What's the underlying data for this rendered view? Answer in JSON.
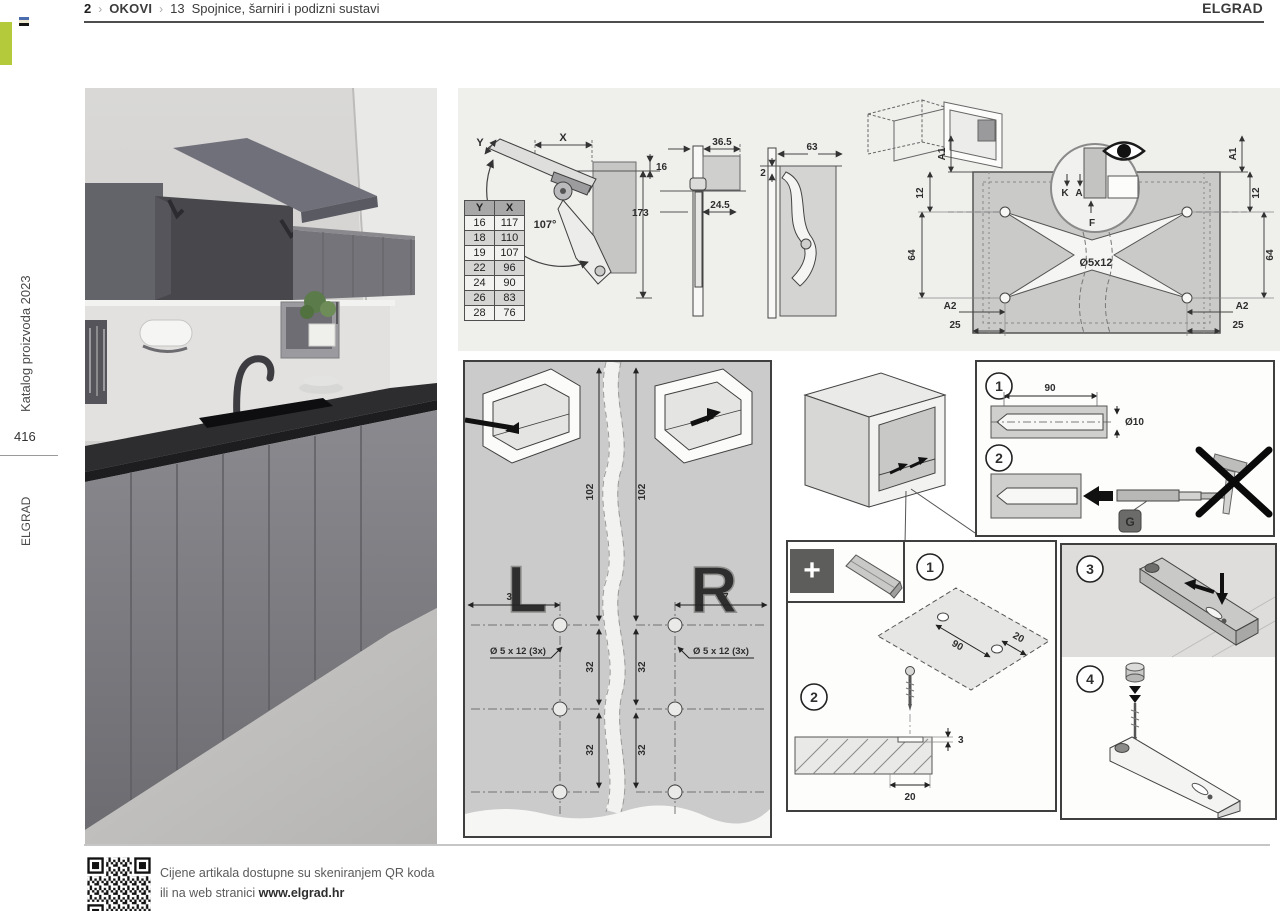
{
  "header": {
    "page_num": "2",
    "separator": "›",
    "section": "OKOVI",
    "chapter_num": "13",
    "chapter_title": "Spojnice, šarniri i podizni sustavi",
    "brand": "ELGRAD"
  },
  "sidebar": {
    "catalog": "Katalog proizvoda 2023",
    "page_number": "416",
    "brand": "ELGRAD"
  },
  "colors": {
    "accent_green": "#b5ca3b"
  },
  "hinge_diagram": {
    "table": {
      "headers": [
        "Y",
        "X"
      ],
      "rows": [
        [
          "16",
          "117"
        ],
        [
          "18",
          "110"
        ],
        [
          "19",
          "107"
        ],
        [
          "22",
          "96"
        ],
        [
          "24",
          "90"
        ],
        [
          "26",
          "83"
        ],
        [
          "28",
          "76"
        ]
      ]
    },
    "angle": "107°",
    "dim_x": "X",
    "dim_y": "Y",
    "dim_16": "16",
    "dim_173": "173"
  },
  "profile_diagram": {
    "dim_36_5": "36.5",
    "dim_24_5": "24.5",
    "dim_63": "63",
    "dim_2": "2"
  },
  "drilling_diagram": {
    "a1": "A1",
    "a2": "A2",
    "d12": "12",
    "d64": "64",
    "d25": "25",
    "hole_spec": "Ø5x12",
    "k": "K",
    "a": "A",
    "f": "F"
  },
  "lr_diagram": {
    "left": "L",
    "right": "R",
    "v102": "102",
    "h37": "37",
    "v32": "32",
    "hole_spec": "Ø 5 x 12 (3x)"
  },
  "dowel_detail": {
    "step1": "1",
    "step2": "2",
    "len": "90",
    "dia": "Ø10",
    "g_label": "G"
  },
  "mounting_steps": {
    "plus": "+",
    "step1": "1",
    "step2": "2",
    "d90": "90",
    "d20": "20",
    "d3": "3",
    "d20_bottom": "20"
  },
  "bar_steps": {
    "step3": "3",
    "step4": "4"
  },
  "footer": {
    "line1": "Cijene artikala dostupne su skeniranjem QR koda",
    "line2_prefix": "ili na web stranici ",
    "line2_url": "www.elgrad.hr"
  }
}
